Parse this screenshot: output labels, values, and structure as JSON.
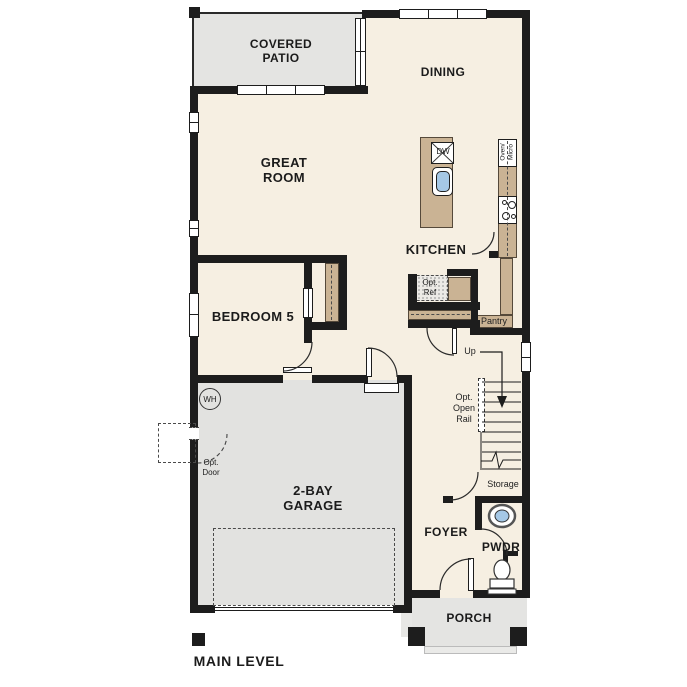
{
  "title": "MAIN LEVEL",
  "rooms": {
    "covered_patio": "COVERED\nPATIO",
    "dining": "DINING",
    "great_room": "GREAT\nROOM",
    "kitchen": "KITCHEN",
    "bedroom5": "BEDROOM 5",
    "garage": "2-BAY\nGARAGE",
    "foyer": "FOYER",
    "powder": "PWDR",
    "porch": "PORCH",
    "pantry": "Pantry",
    "storage": "Storage"
  },
  "annotations": {
    "up": "Up",
    "opt_open_rail": "Opt.\nOpen\nRail",
    "opt_door": "Opt.\nDoor",
    "opt_ref": "Opt.\nRef",
    "water_heater": "WH",
    "dishwasher": "DW",
    "oven_micro": "Oven/\nMicro"
  },
  "colors": {
    "floor_cream": "#f6efe2",
    "exterior_gray": "#e4e4e2",
    "garage_gray": "#e2e2e0",
    "counter_tan": "#cab394",
    "wall_black": "#1d1d1d",
    "sink_blue": "#a5c8e6"
  }
}
